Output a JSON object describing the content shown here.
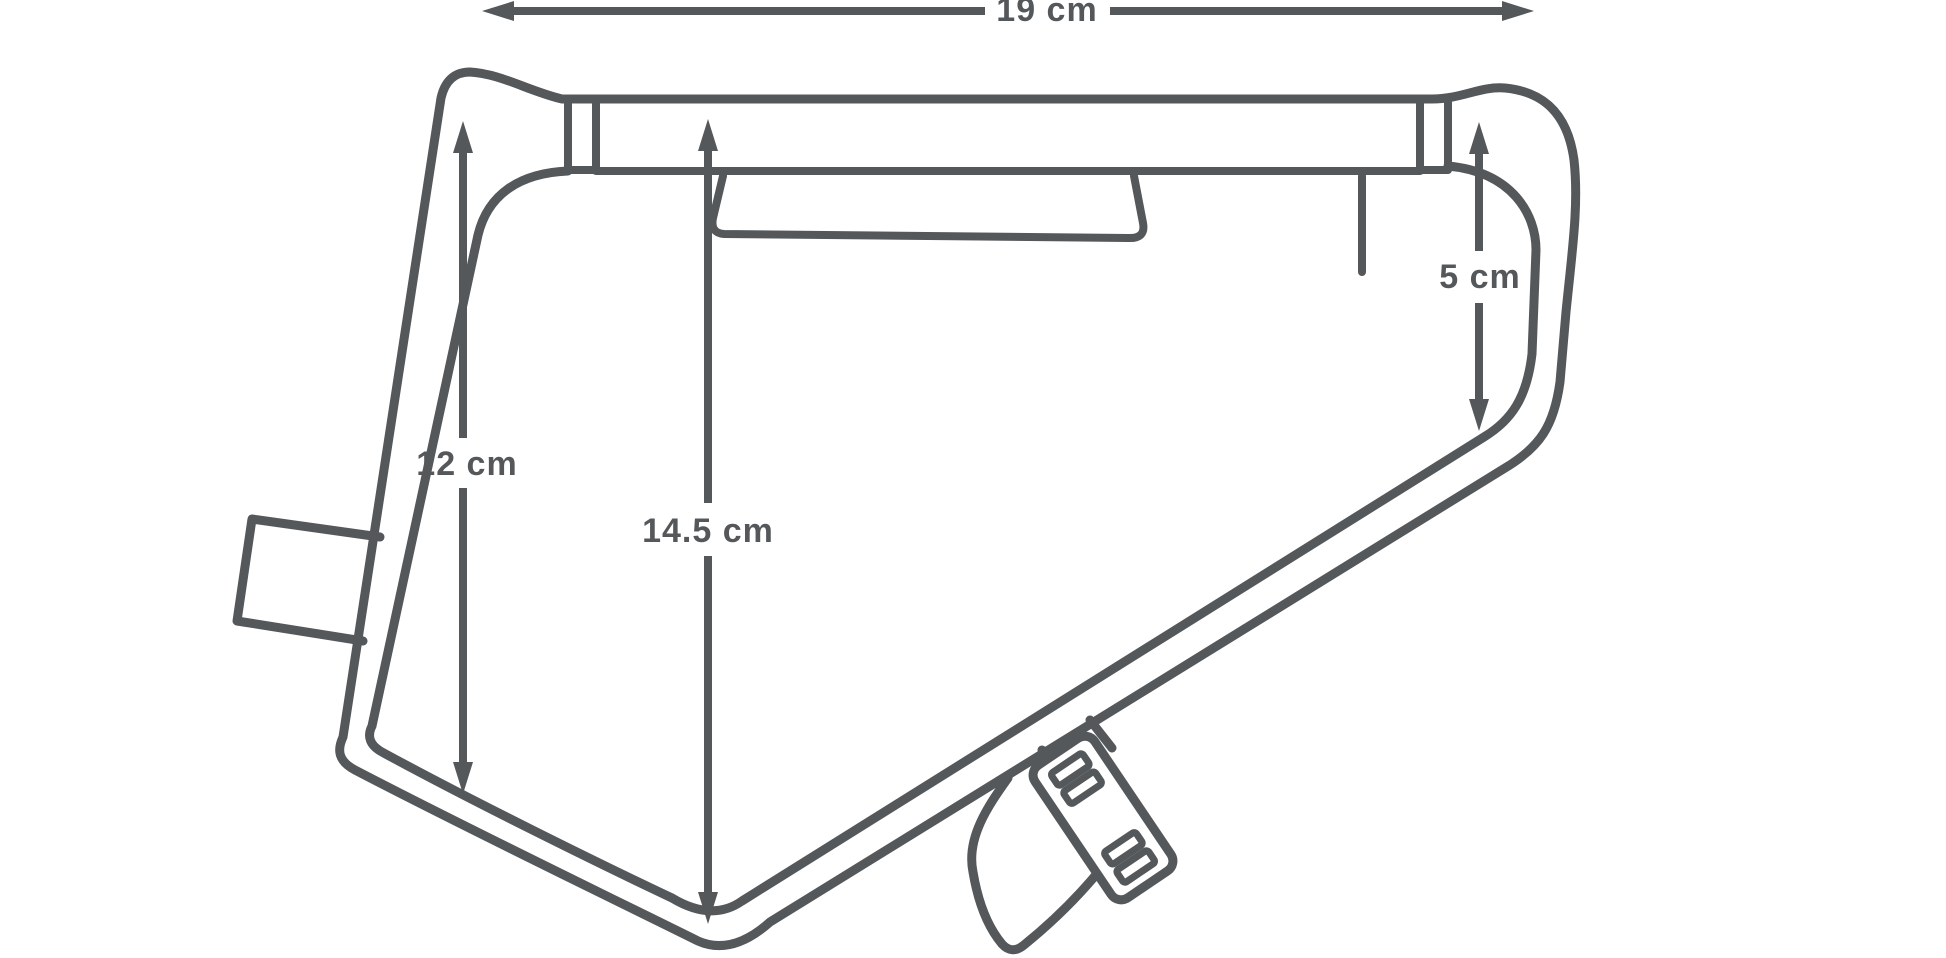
{
  "diagram": {
    "title": "frame-bag-dimension-diagram",
    "line_color": "#54585b",
    "background_color": "#ffffff",
    "dimensions": {
      "top_width": "19 cm",
      "left_height": "12 cm",
      "center_height": "14.5 cm",
      "right_height": "5 cm"
    }
  }
}
